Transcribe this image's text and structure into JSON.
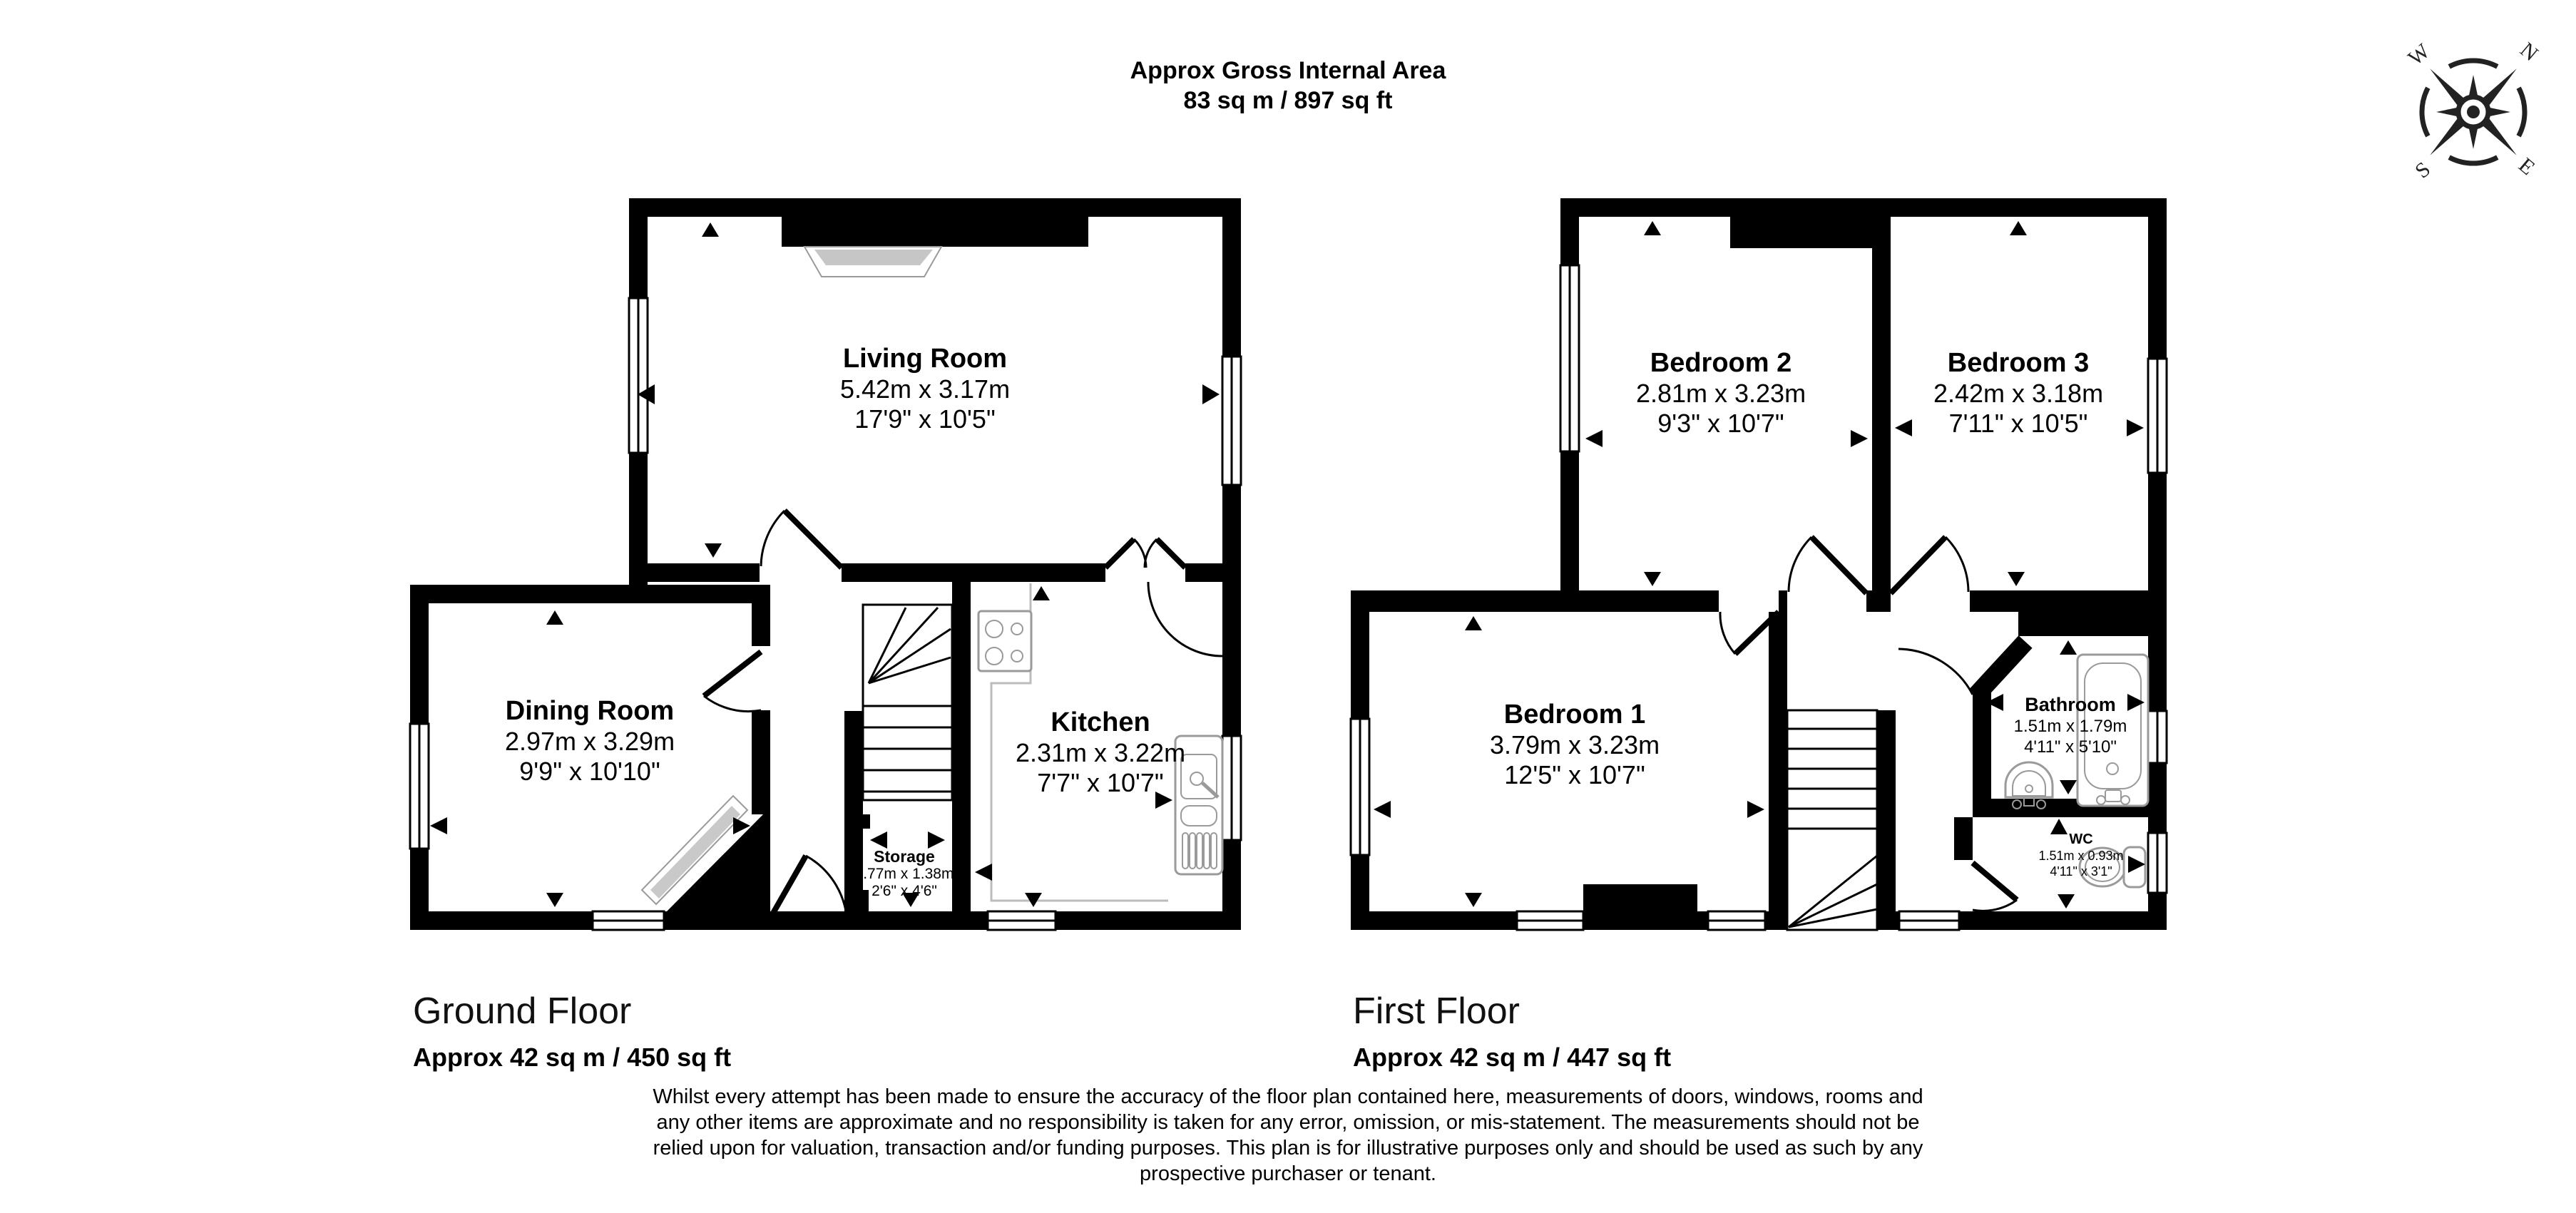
{
  "title": {
    "line1": "Approx Gross Internal Area",
    "line2": "83 sq m / 897 sq ft"
  },
  "compass": {
    "n": "N",
    "e": "E",
    "s": "S",
    "w": "W"
  },
  "floors": [
    {
      "label": "Ground Floor",
      "area": "Approx 42 sq m / 450 sq ft",
      "rooms": [
        {
          "name": "Living Room",
          "metric": "5.42m x 3.17m",
          "imperial": "17'9\" x 10'5\""
        },
        {
          "name": "Dining Room",
          "metric": "2.97m x 3.29m",
          "imperial": "9'9\" x 10'10\""
        },
        {
          "name": "Kitchen",
          "metric": "2.31m x 3.22m",
          "imperial": "7'7\" x 10'7\""
        },
        {
          "name": "Storage",
          "metric": "0.77m x 1.38m",
          "imperial": "2'6\" x 4'6\""
        }
      ]
    },
    {
      "label": "First Floor",
      "area": "Approx 42 sq m / 447 sq ft",
      "rooms": [
        {
          "name": "Bedroom 2",
          "metric": "2.81m x 3.23m",
          "imperial": "9'3\" x 10'7\""
        },
        {
          "name": "Bedroom 3",
          "metric": "2.42m x 3.18m",
          "imperial": "7'11\" x 10'5\""
        },
        {
          "name": "Bedroom 1",
          "metric": "3.79m x 3.23m",
          "imperial": "12'5\" x 10'7\""
        },
        {
          "name": "Bathroom",
          "metric": "1.51m x 1.79m",
          "imperial": "4'11\" x 5'10\""
        },
        {
          "name": "WC",
          "metric": "1.51m x 0.93m",
          "imperial": "4'11\" x 3'1\""
        }
      ]
    }
  ],
  "disclaimer": {
    "line1": "Whilst every attempt has been made to ensure the accuracy of the floor plan contained here, measurements of doors, windows, rooms and",
    "line2": "any other items are approximate and no responsibility is taken for any error, omission, or mis-statement. The measurements should not be",
    "line3": "relied upon for valuation, transaction and/or funding purposes. This plan is for illustrative purposes only and should be used as such by any",
    "line4": "prospective purchaser or tenant."
  },
  "colors": {
    "wall": "#000000",
    "furniture": "#9a9a9a",
    "glazing": "#c9c9c9"
  }
}
